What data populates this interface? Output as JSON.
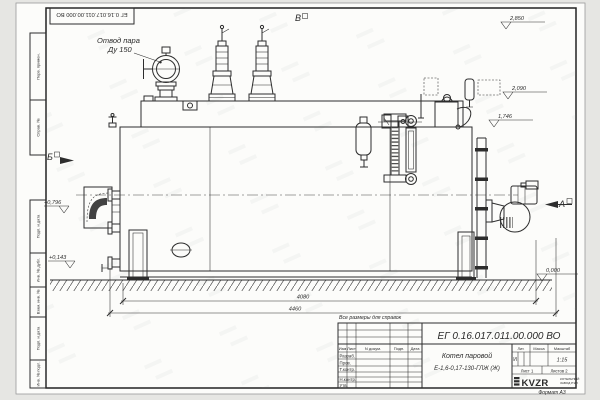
{
  "colors": {
    "ink": "#2d2d2d",
    "paper": "#fcfcfa",
    "background": "#e6e6e3"
  },
  "stamp": {
    "doc_number_inverted": "ЕГ 0.16.017.011.00.000  ВО"
  },
  "margin_labels": {
    "perv_primen": "Перв. примен.",
    "sprav_no": "Справ. №",
    "podp_data_upper": "Подп. и дата",
    "inv_dubl": "Инв. № дубл.",
    "vzam_inv": "Взам. инв. №",
    "podp_data_lower": "Подп. и дата",
    "inv_podl": "Инв. № подл."
  },
  "annotation": {
    "line1": "Отвод пара",
    "line2": "Ду 150"
  },
  "view_labels": {
    "top": "В",
    "left": "Б",
    "right": "А"
  },
  "elevations": {
    "top_right": "2,850",
    "mid_right": "2,090",
    "low_right": "1,746",
    "ground": "0,000",
    "front_upper": "+0,796",
    "front_lower": "+0,143"
  },
  "dimensions": {
    "between_supports": "4080",
    "overall": "4460"
  },
  "notes": {
    "for_reference": "Все размеры для справок"
  },
  "title_block": {
    "doc_number": "ЕГ 0.16.017.011.00.000  ВО",
    "product_name": "Котел паровой",
    "designation": "Е-1,6-0,17-130-ГЛЖ (Ж)",
    "col_izm": "Изм",
    "col_list": "Лист",
    "col_doc": "N докум.",
    "col_podp": "Подп.",
    "col_data": "Дата",
    "row_razrab": "Разраб.",
    "row_prov": "Пров.",
    "row_tkontr": "Т.контр.",
    "row_nkontr": "Н.контр.",
    "row_utv": "Утв.",
    "lit_header": "Лит.",
    "mass_header": "Масса",
    "scale_header": "Масштаб",
    "lit_value": "И",
    "scale_value": "1:15",
    "sheet": "Лист 1",
    "sheets": "Листов  2",
    "brand": "KVZR",
    "brand_line1": "КОТЕЛЬНЫЙ",
    "brand_line2": "ЗАВОД РЭП",
    "format_note": "Формат А3"
  }
}
